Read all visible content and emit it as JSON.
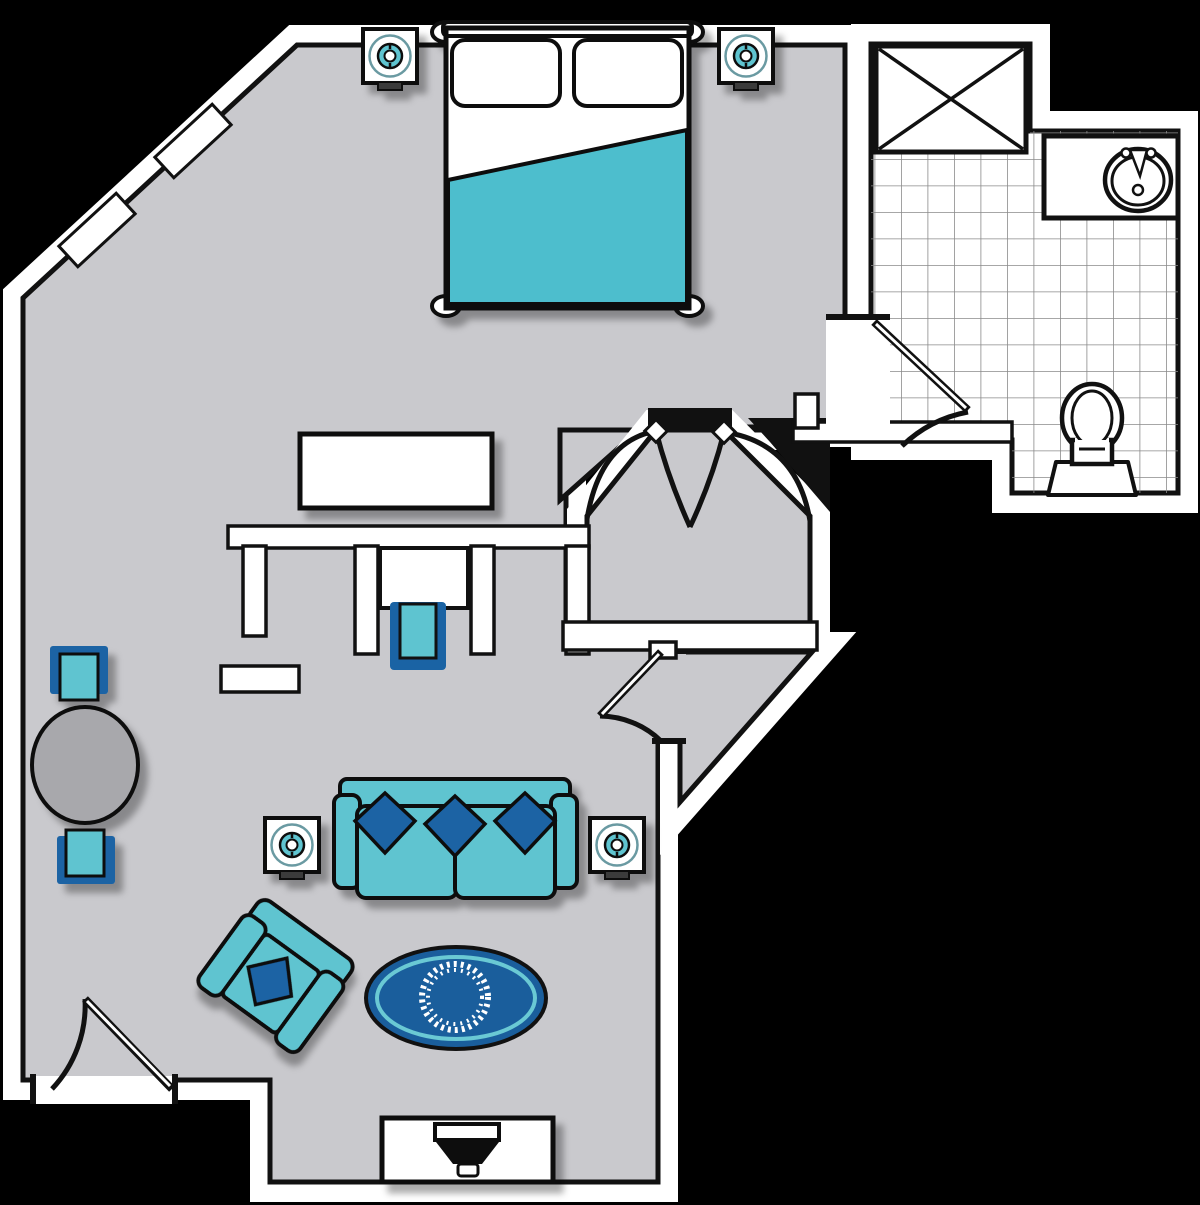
{
  "title": "studio-suite-floor-plan",
  "colors": {
    "background": "#000000",
    "floor": "#c9c9cd",
    "wall": "#ffffff",
    "line": "#111111",
    "teal": "#5ec4d0",
    "blanket": "#4dbecd",
    "blue": "#1a63a4",
    "rug_blue": "#1a5e9c",
    "rug_ring": "#6ac9d4",
    "table_gray": "#a8a8ac",
    "tile_line": "#8a8a8a",
    "lamp_ring": "#6b9aa2"
  },
  "icons": [
    {
      "id": "bed-icon",
      "label": "double bed with teal blanket and two pillows"
    },
    {
      "id": "nightstand-lamp-icon",
      "label": "nightstand with round table lamp"
    },
    {
      "id": "dresser-icon",
      "label": "dresser / credenza"
    },
    {
      "id": "closet-desk-icon",
      "label": "built-in closet with desk nook"
    },
    {
      "id": "desk-chair-icon",
      "label": "desk chair"
    },
    {
      "id": "dining-table-icon",
      "label": "round table with two chairs"
    },
    {
      "id": "sofa-icon",
      "label": "sofa with three throw pillows"
    },
    {
      "id": "side-table-lamp-icon",
      "label": "side table with lamp"
    },
    {
      "id": "armchair-icon",
      "label": "angled armchair with pillow"
    },
    {
      "id": "rug-icon",
      "label": "oval area rug with wreath medallion"
    },
    {
      "id": "tv-stand-icon",
      "label": "media stand with television"
    },
    {
      "id": "shower-icon",
      "label": "shower stall (crossed box)"
    },
    {
      "id": "sink-icon",
      "label": "vanity with oval sink"
    },
    {
      "id": "toilet-icon",
      "label": "toilet"
    },
    {
      "id": "door-arc-icon",
      "label": "door swing arc"
    },
    {
      "id": "double-door-icon",
      "label": "double entry door swing"
    },
    {
      "id": "window-icon",
      "label": "window on angled wall"
    }
  ]
}
